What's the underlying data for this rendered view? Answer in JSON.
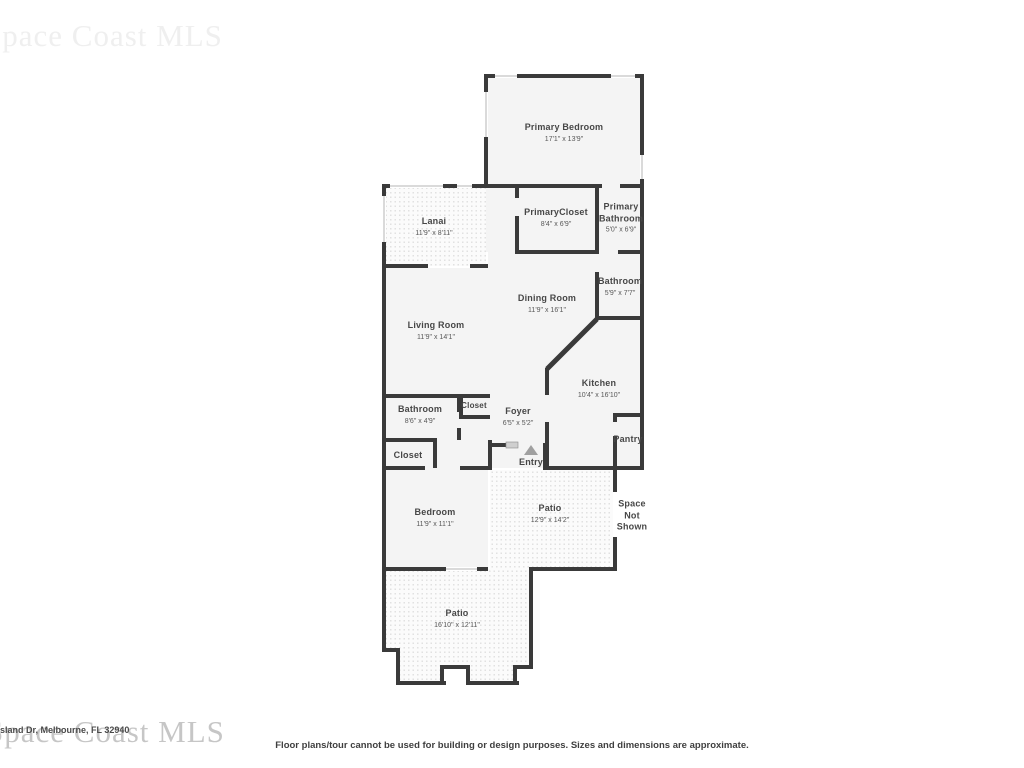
{
  "watermarks": {
    "top": "Space Coast MLS",
    "bottom": "Space Coast MLS"
  },
  "footer": {
    "address": "sland Dr, Melbourne, FL 32940",
    "disclaimer": "Floor plans/tour cannot be used for building or design purposes. Sizes and dimensions are approximate."
  },
  "colors": {
    "wall": "#3a3a3a",
    "room_fill": "#f4f4f4",
    "patio_fill": "#fbfbfb",
    "patio_dot": "#e1e1e1",
    "label_text": "#474747",
    "watermark": "#c6c6c6",
    "entry_marker": "#a0a0a0"
  },
  "icons": {
    "entry_marker": "triangle-up-icon"
  },
  "rooms": [
    {
      "id": "primary-bedroom",
      "name": "Primary Bedroom",
      "dims": "17'1\" x 13'9\""
    },
    {
      "id": "primary-closet",
      "name": "PrimaryCloset",
      "dims": "8'4\" x 6'9\""
    },
    {
      "id": "primary-bathroom",
      "name": "Primary Bathroom",
      "dims": "5'0\" x 6'9\""
    },
    {
      "id": "lanai",
      "name": "Lanai",
      "dims": "11'9\" x 8'11\""
    },
    {
      "id": "bathroom-upper",
      "name": "Bathroom",
      "dims": "5'9\" x 7'7\""
    },
    {
      "id": "dining-room",
      "name": "Dining Room",
      "dims": "11'9\" x 16'1\""
    },
    {
      "id": "living-room",
      "name": "Living Room",
      "dims": "11'9\" x 14'1\""
    },
    {
      "id": "kitchen",
      "name": "Kitchen",
      "dims": "10'4\" x 16'10\""
    },
    {
      "id": "closet-small",
      "name": "Closet",
      "dims": ""
    },
    {
      "id": "bathroom-lower",
      "name": "Bathroom",
      "dims": "8'6\" x 4'9\""
    },
    {
      "id": "foyer",
      "name": "Foyer",
      "dims": "6'5\" x 5'2\""
    },
    {
      "id": "closet-left",
      "name": "Closet",
      "dims": ""
    },
    {
      "id": "entry",
      "name": "Entry",
      "dims": ""
    },
    {
      "id": "pantry",
      "name": "Pantry",
      "dims": ""
    },
    {
      "id": "bedroom",
      "name": "Bedroom",
      "dims": "11'9\" x 11'1\""
    },
    {
      "id": "patio-middle",
      "name": "Patio",
      "dims": "12'9\" x 14'2\""
    },
    {
      "id": "space-not-shown",
      "name": "Space Not Shown",
      "dims": ""
    },
    {
      "id": "patio-bottom",
      "name": "Patio",
      "dims": "16'10\" x 12'11\""
    }
  ]
}
